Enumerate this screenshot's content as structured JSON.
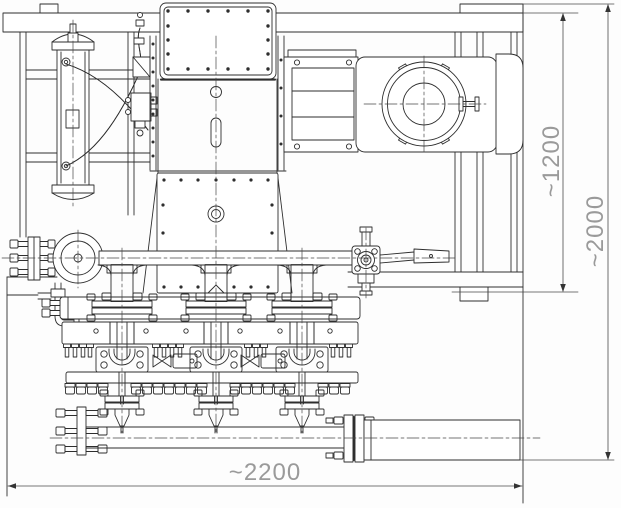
{
  "drawing": {
    "background": "#ffffff",
    "dimensions": {
      "frame_height": {
        "label": "~1200",
        "orientation": "vertical",
        "position": "right-inner"
      },
      "overall_height": {
        "label": "~2000",
        "orientation": "vertical",
        "position": "right-outer"
      },
      "overall_width": {
        "label": "~2200",
        "orientation": "horizontal",
        "position": "bottom"
      }
    },
    "colors": {
      "line": "#2e2e2e",
      "dimension_line": "#4a4a4a",
      "dimension_text": "#9a9a9a"
    },
    "components": [
      "support-frame",
      "pulsation-dampener",
      "hose-lines",
      "lubricator-block",
      "gearbox",
      "crankcase-cover",
      "coupling-housing",
      "electric-motor",
      "motor-fan-cover",
      "inlet-flange",
      "suction-elbow",
      "suction-header",
      "drain-line",
      "lever-valve",
      "pump-head-1",
      "pump-head-2",
      "pump-head-3",
      "valve-blocks",
      "discharge-manifold",
      "manifold-blind-flange",
      "manifold-flange-joint",
      "outlet-pipe"
    ]
  }
}
